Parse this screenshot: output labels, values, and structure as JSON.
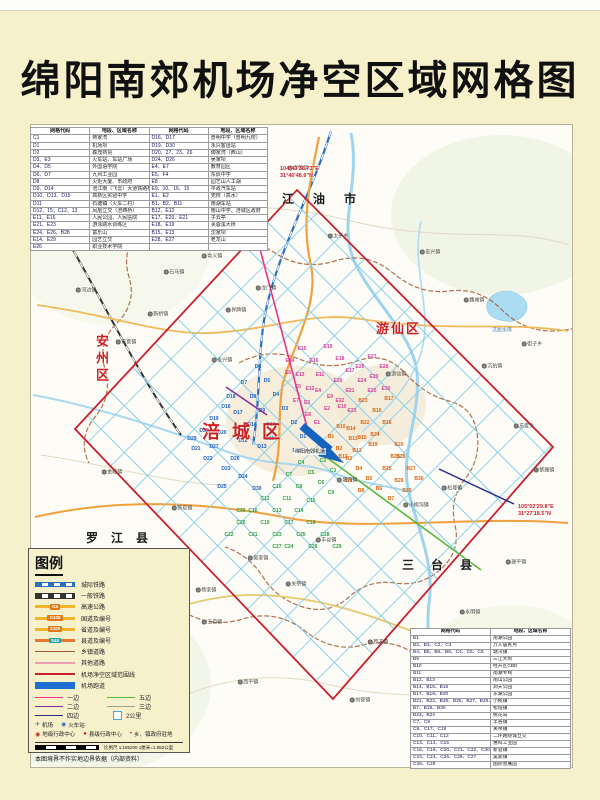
{
  "title": "绵阳南郊机场净空区域网格图",
  "colors": {
    "page_bg": "#f6f0cb",
    "boundary_red": "#c8202e",
    "grid_blue": "#86cfe8",
    "runway_blue": "#1565c0",
    "grid_codes": {
      "D": "#1d5fc4",
      "E": "#d93f9b",
      "C": "#2f9e44",
      "B": "#e0640f"
    }
  },
  "table_top_left": {
    "headers": [
      "网格代码",
      "地段、区域名称",
      "网格代码",
      "地段、区域名称"
    ],
    "rows": [
      [
        "C1",
        "蒋家湾",
        "D16、D17",
        "普明中学（普明九校）"
      ],
      [
        "D1",
        "机场坝",
        "D19、D30",
        "永兴客运站"
      ],
      [
        "D2",
        "森茂商贸",
        "D20、27、23、26",
        "御家湾（西山）"
      ],
      [
        "D3、E3",
        "火车站、车站广场",
        "D24、D26",
        "吴家坝"
      ],
      [
        "D4、D5",
        "外国语学院",
        "E4、E7",
        "教育园区"
      ],
      [
        "D6、D7",
        "九州工业园",
        "E5、F4",
        "东辰中学"
      ],
      [
        "D8",
        "火炬大厦、市政府",
        "E8",
        "园艺山人工湖"
      ],
      [
        "D9、D14",
        "涪江南（飞云）大道铁路桥",
        "E9、10、16、15",
        "平政汽车站"
      ],
      [
        "D10、D13、D15",
        "高新区实验中学",
        "E1、E2",
        "党校（高水）"
      ],
      [
        "D11",
        "石塘镇（火车二村）",
        "B1、B2、B11",
        "南湖车站"
      ],
      [
        "D12、15；C12、13",
        "凤凰立交（涪西桥）",
        "B12、E12",
        "南山中学、涪城区政府"
      ],
      [
        "E11、E16",
        "人民公园、人民医院",
        "E17、E20、E21",
        "子云亭"
      ],
      [
        "E21、E23",
        "游泳跳水训练区",
        "E18、E19",
        "芙蓉溪大桥"
      ],
      [
        "E24、E26、B28",
        "富乐山",
        "B15、E13",
        "沈家坝"
      ],
      [
        "E14、E29",
        "园艺立交",
        "E28、E27",
        "老龙山"
      ],
      [
        "E26",
        "职业技术学院",
        "",
        ""
      ]
    ]
  },
  "table_bottom_right": {
    "headers": [
      "网格代码",
      "地段、区域名称"
    ],
    "rows": [
      [
        "B1",
        "南湖公园"
      ],
      [
        "B2、B3、C2、C3",
        "万人居民点"
      ],
      [
        "B4、B5、B6、B8、C4、C5、C6",
        "塘汛镇"
      ],
      [
        "B9",
        "三江大坝"
      ],
      [
        "B10",
        "经开区CBD"
      ],
      [
        "B11",
        "南湖专线"
      ],
      [
        "B12、B13",
        "南山公园"
      ],
      [
        "B14、B15、B16",
        "洞天公园"
      ],
      [
        "B17、B18、B20",
        "东湖公园"
      ],
      [
        "B21、B22、B25、B26、B27、B28、B29",
        "小枧镇"
      ],
      [
        "B7、B19、B30",
        "松垭镇"
      ],
      [
        "B23、B24",
        "桃花岛"
      ],
      [
        "C7、C9",
        "丰谷镇"
      ],
      [
        "C8、C17、C18",
        "关帝镇"
      ],
      [
        "C10、C11、C12",
        "二环路绕城立交"
      ],
      [
        "C13、C14、C15",
        "惠科工业园"
      ],
      [
        "C16、C19、C20、C21、C22、C30",
        "新皂镇"
      ],
      [
        "C23、C24、C25、C26、C27",
        "吴家镇"
      ],
      [
        "C28、C29",
        "国际会展园"
      ]
    ]
  },
  "legend": {
    "title": "图例",
    "line_items": [
      {
        "label": "城际铁路",
        "type": "rail",
        "color": "#2a6fc0"
      },
      {
        "label": "一般铁路",
        "type": "rail",
        "color": "#333333"
      },
      {
        "label": "高速公路",
        "type": "road",
        "color": "#f3b32c",
        "badge": "G5",
        "badge_bg": "#e07818"
      },
      {
        "label": "国道及编号",
        "type": "road",
        "color": "#f3b32c",
        "badge": "G108",
        "badge_bg": "#e07818"
      },
      {
        "label": "省道及编号",
        "type": "road",
        "color": "#f3b32c",
        "badge": "S105",
        "badge_bg": "#e07818"
      },
      {
        "label": "县道及编号",
        "type": "road",
        "color": "#e87830",
        "badge": "S40",
        "badge_bg": "#27a39b"
      },
      {
        "label": "乡镇道路",
        "type": "line",
        "color": "#a85a30",
        "h": 1
      },
      {
        "label": "其他道路",
        "type": "line",
        "color": "#e8a0ae",
        "h": 2
      },
      {
        "label": "机场净空区域范围线",
        "type": "line",
        "color": "#cc1f2e",
        "h": 2
      },
      {
        "label": "机场跑道",
        "type": "line",
        "color": "#1f6fd0",
        "h": 7
      }
    ],
    "edges": [
      {
        "label": "一边",
        "color": "#e8358a"
      },
      {
        "label": "五边",
        "color": "#5cb83c"
      },
      {
        "label": "二边",
        "color": "#8a2d9c"
      },
      {
        "label": "三边",
        "color": "#9aa48e"
      },
      {
        "label": "四边",
        "color": "#2a2a8c"
      }
    ],
    "square_label": "2公里",
    "symbols_row1": [
      {
        "glyph": "✈",
        "color": "#2a6fc0",
        "label": "机场"
      },
      {
        "glyph": "◉",
        "color": "#2a6fc0",
        "label": "火车站"
      }
    ],
    "symbols_row2": [
      {
        "glyph": "◉",
        "color": "#cc2222",
        "label": "地级行政中心"
      },
      {
        "glyph": "●",
        "color": "#cc2222",
        "label": "县级行政中心"
      },
      {
        "glyph": "•",
        "color": "#cc2222",
        "label": "乡、镇政府驻地"
      }
    ],
    "scale_text": "比例尺 1:185200  1厘米=1.852公里",
    "disclaimer": "本图境界不作实地边界依据（内部资料）"
  },
  "map": {
    "airport_label": "绵阳南郊机场",
    "district_labels": [
      {
        "text": "江 油 市",
        "x": 282,
        "y": 190,
        "color": "#1a1a1a",
        "size": 12,
        "ls": 8,
        "vertical": false
      },
      {
        "text": "安州区",
        "x": 92,
        "y": 334,
        "color": "#cc2222",
        "size": 13,
        "ls": 4,
        "vertical": true
      },
      {
        "text": "游仙区",
        "x": 376,
        "y": 318,
        "color": "#cc2222",
        "size": 13,
        "ls": 2,
        "vertical": false
      },
      {
        "text": "涪城区",
        "x": 202,
        "y": 418,
        "color": "#cc2222",
        "size": 18,
        "ls": 12,
        "vertical": false
      },
      {
        "text": "罗 江 县",
        "x": 86,
        "y": 529,
        "color": "#1a1a1a",
        "size": 12,
        "ls": 5,
        "vertical": false
      },
      {
        "text": "三 台 县",
        "x": 402,
        "y": 556,
        "color": "#1a1a1a",
        "size": 12,
        "ls": 7,
        "vertical": false
      }
    ],
    "coord_labels": [
      {
        "line1": "104°43'36.73\"E",
        "line2": "31°40'48.6\"N",
        "x": 280,
        "y": 166
      },
      {
        "line1": "105°02'29.8\"E",
        "line2": "31°27'18.5\"N",
        "x": 518,
        "y": 504
      }
    ],
    "water_labels": [
      {
        "text": "沉抗水库",
        "x": 502,
        "y": 330
      }
    ],
    "grid_labels": [
      {
        "c": "D1",
        "x": 303,
        "y": 437
      },
      {
        "c": "D2",
        "x": 294,
        "y": 423
      },
      {
        "c": "D3",
        "x": 285,
        "y": 409
      },
      {
        "c": "D4",
        "x": 276,
        "y": 395
      },
      {
        "c": "D5",
        "x": 267,
        "y": 381
      },
      {
        "c": "D6",
        "x": 258,
        "y": 367
      },
      {
        "c": "D7",
        "x": 244,
        "y": 383
      },
      {
        "c": "D8",
        "x": 253,
        "y": 397
      },
      {
        "c": "D9",
        "x": 262,
        "y": 411
      },
      {
        "c": "D10",
        "x": 271,
        "y": 425
      },
      {
        "c": "D11",
        "x": 297,
        "y": 451
      },
      {
        "c": "D12",
        "x": 243,
        "y": 441
      },
      {
        "c": "D13",
        "x": 262,
        "y": 447
      },
      {
        "c": "D14",
        "x": 252,
        "y": 425
      },
      {
        "c": "D15",
        "x": 270,
        "y": 439
      },
      {
        "c": "D16",
        "x": 226,
        "y": 407
      },
      {
        "c": "D17",
        "x": 238,
        "y": 413
      },
      {
        "c": "D18",
        "x": 231,
        "y": 397
      },
      {
        "c": "D19",
        "x": 214,
        "y": 419
      },
      {
        "c": "D20",
        "x": 222,
        "y": 433
      },
      {
        "c": "D21",
        "x": 196,
        "y": 449
      },
      {
        "c": "D22",
        "x": 208,
        "y": 459
      },
      {
        "c": "D23",
        "x": 226,
        "y": 469
      },
      {
        "c": "D24",
        "x": 243,
        "y": 477
      },
      {
        "c": "D25",
        "x": 222,
        "y": 487
      },
      {
        "c": "D26",
        "x": 235,
        "y": 459
      },
      {
        "c": "D27",
        "x": 214,
        "y": 447
      },
      {
        "c": "D28",
        "x": 204,
        "y": 431
      },
      {
        "c": "D29",
        "x": 192,
        "y": 439
      },
      {
        "c": "D30",
        "x": 257,
        "y": 489
      },
      {
        "c": "E1",
        "x": 317,
        "y": 423
      },
      {
        "c": "E2",
        "x": 327,
        "y": 409
      },
      {
        "c": "E3",
        "x": 307,
        "y": 403
      },
      {
        "c": "E4",
        "x": 318,
        "y": 391
      },
      {
        "c": "E5",
        "x": 298,
        "y": 387
      },
      {
        "c": "E6",
        "x": 288,
        "y": 373
      },
      {
        "c": "E7",
        "x": 296,
        "y": 401
      },
      {
        "c": "E8",
        "x": 308,
        "y": 415
      },
      {
        "c": "E9",
        "x": 330,
        "y": 397
      },
      {
        "c": "E10",
        "x": 342,
        "y": 407
      },
      {
        "c": "E11",
        "x": 320,
        "y": 375
      },
      {
        "c": "E12",
        "x": 310,
        "y": 389
      },
      {
        "c": "E13",
        "x": 300,
        "y": 375
      },
      {
        "c": "E14",
        "x": 290,
        "y": 361
      },
      {
        "c": "E15",
        "x": 302,
        "y": 349
      },
      {
        "c": "E16",
        "x": 314,
        "y": 361
      },
      {
        "c": "E17",
        "x": 350,
        "y": 371
      },
      {
        "c": "E18",
        "x": 340,
        "y": 359
      },
      {
        "c": "E19",
        "x": 328,
        "y": 347
      },
      {
        "c": "E20",
        "x": 338,
        "y": 381
      },
      {
        "c": "E21",
        "x": 350,
        "y": 391
      },
      {
        "c": "E22",
        "x": 340,
        "y": 401
      },
      {
        "c": "E23",
        "x": 352,
        "y": 411
      },
      {
        "c": "E24",
        "x": 362,
        "y": 381
      },
      {
        "c": "E25",
        "x": 372,
        "y": 391
      },
      {
        "c": "E26",
        "x": 360,
        "y": 367
      },
      {
        "c": "E27",
        "x": 372,
        "y": 357
      },
      {
        "c": "E28",
        "x": 384,
        "y": 367
      },
      {
        "c": "E29",
        "x": 374,
        "y": 377
      },
      {
        "c": "E30",
        "x": 386,
        "y": 389
      },
      {
        "c": "B1",
        "x": 331,
        "y": 437
      },
      {
        "c": "B2",
        "x": 339,
        "y": 449
      },
      {
        "c": "B3",
        "x": 349,
        "y": 459
      },
      {
        "c": "B4",
        "x": 359,
        "y": 469
      },
      {
        "c": "B5",
        "x": 369,
        "y": 479
      },
      {
        "c": "B6",
        "x": 379,
        "y": 489
      },
      {
        "c": "B7",
        "x": 391,
        "y": 499
      },
      {
        "c": "B8",
        "x": 361,
        "y": 491
      },
      {
        "c": "B9",
        "x": 349,
        "y": 481
      },
      {
        "c": "B10",
        "x": 341,
        "y": 427
      },
      {
        "c": "B11",
        "x": 353,
        "y": 439
      },
      {
        "c": "B12",
        "x": 343,
        "y": 457
      },
      {
        "c": "B13",
        "x": 357,
        "y": 451
      },
      {
        "c": "B14",
        "x": 351,
        "y": 429
      },
      {
        "c": "B15",
        "x": 362,
        "y": 438
      },
      {
        "c": "B16",
        "x": 377,
        "y": 411
      },
      {
        "c": "B17",
        "x": 389,
        "y": 399
      },
      {
        "c": "B18",
        "x": 387,
        "y": 423
      },
      {
        "c": "B19",
        "x": 373,
        "y": 445
      },
      {
        "c": "B20",
        "x": 399,
        "y": 445
      },
      {
        "c": "B21",
        "x": 395,
        "y": 457
      },
      {
        "c": "B22",
        "x": 365,
        "y": 423
      },
      {
        "c": "B23",
        "x": 363,
        "y": 401
      },
      {
        "c": "B24",
        "x": 375,
        "y": 435
      },
      {
        "c": "B25",
        "x": 387,
        "y": 469
      },
      {
        "c": "B26",
        "x": 399,
        "y": 481
      },
      {
        "c": "B27",
        "x": 411,
        "y": 469
      },
      {
        "c": "B28",
        "x": 401,
        "y": 457
      },
      {
        "c": "B29",
        "x": 407,
        "y": 491
      },
      {
        "c": "B30",
        "x": 419,
        "y": 479
      },
      {
        "c": "C1",
        "x": 313,
        "y": 451
      },
      {
        "c": "C2",
        "x": 323,
        "y": 461
      },
      {
        "c": "C3",
        "x": 333,
        "y": 471
      },
      {
        "c": "C4",
        "x": 301,
        "y": 463
      },
      {
        "c": "C5",
        "x": 311,
        "y": 473
      },
      {
        "c": "C6",
        "x": 321,
        "y": 483
      },
      {
        "c": "C7",
        "x": 289,
        "y": 475
      },
      {
        "c": "C8",
        "x": 299,
        "y": 487
      },
      {
        "c": "C9",
        "x": 331,
        "y": 493
      },
      {
        "c": "C10",
        "x": 277,
        "y": 487
      },
      {
        "c": "C11",
        "x": 287,
        "y": 499
      },
      {
        "c": "C12",
        "x": 265,
        "y": 499
      },
      {
        "c": "C13",
        "x": 277,
        "y": 511
      },
      {
        "c": "C14",
        "x": 299,
        "y": 511
      },
      {
        "c": "C15",
        "x": 311,
        "y": 501
      },
      {
        "c": "C16",
        "x": 253,
        "y": 511
      },
      {
        "c": "C17",
        "x": 289,
        "y": 523
      },
      {
        "c": "C18",
        "x": 311,
        "y": 523
      },
      {
        "c": "C19",
        "x": 265,
        "y": 523
      },
      {
        "c": "C20",
        "x": 241,
        "y": 523
      },
      {
        "c": "C21",
        "x": 253,
        "y": 535
      },
      {
        "c": "C22",
        "x": 229,
        "y": 535
      },
      {
        "c": "C23",
        "x": 277,
        "y": 535
      },
      {
        "c": "C24",
        "x": 289,
        "y": 547
      },
      {
        "c": "C25",
        "x": 301,
        "y": 535
      },
      {
        "c": "C26",
        "x": 313,
        "y": 547
      },
      {
        "c": "C27",
        "x": 277,
        "y": 547
      },
      {
        "c": "C28",
        "x": 325,
        "y": 535
      },
      {
        "c": "C29",
        "x": 337,
        "y": 547
      },
      {
        "c": "C30",
        "x": 241,
        "y": 511
      }
    ],
    "towns": [
      {
        "n": "青义镇",
        "x": 212,
        "y": 256
      },
      {
        "n": "石马镇",
        "x": 174,
        "y": 272
      },
      {
        "n": "龙门镇",
        "x": 266,
        "y": 288
      },
      {
        "n": "新桥镇",
        "x": 158,
        "y": 314
      },
      {
        "n": "花荄镇",
        "x": 126,
        "y": 342
      },
      {
        "n": "界牌镇",
        "x": 236,
        "y": 310
      },
      {
        "n": "永兴镇",
        "x": 222,
        "y": 360
      },
      {
        "n": "河边镇",
        "x": 86,
        "y": 290
      },
      {
        "n": "柏林镇",
        "x": 148,
        "y": 238
      },
      {
        "n": "青莲镇",
        "x": 298,
        "y": 168
      },
      {
        "n": "九岭镇",
        "x": 144,
        "y": 198
      },
      {
        "n": "忠兴镇",
        "x": 430,
        "y": 252
      },
      {
        "n": "太平乡",
        "x": 338,
        "y": 236
      },
      {
        "n": "魏城镇",
        "x": 474,
        "y": 300
      },
      {
        "n": "沉抗镇",
        "x": 492,
        "y": 366
      },
      {
        "n": "街子乡",
        "x": 532,
        "y": 344
      },
      {
        "n": "游仙镇",
        "x": 396,
        "y": 374
      },
      {
        "n": "东宣乡",
        "x": 524,
        "y": 426
      },
      {
        "n": "黎雅镇",
        "x": 544,
        "y": 470
      },
      {
        "n": "塘汛镇",
        "x": 347,
        "y": 480
      },
      {
        "n": "丰谷镇",
        "x": 326,
        "y": 540
      },
      {
        "n": "松垭镇",
        "x": 452,
        "y": 488
      },
      {
        "n": "小枧沟镇",
        "x": 416,
        "y": 505
      },
      {
        "n": "吴家镇",
        "x": 258,
        "y": 558
      },
      {
        "n": "新皂镇",
        "x": 182,
        "y": 508
      },
      {
        "n": "关帝镇",
        "x": 296,
        "y": 584
      },
      {
        "n": "杨家镇",
        "x": 206,
        "y": 590
      },
      {
        "n": "玉皇镇",
        "x": 212,
        "y": 622
      },
      {
        "n": "金峰镇",
        "x": 112,
        "y": 472
      },
      {
        "n": "芦溪镇",
        "x": 378,
        "y": 642
      },
      {
        "n": "永明镇",
        "x": 470,
        "y": 612
      },
      {
        "n": "建平镇",
        "x": 516,
        "y": 562
      },
      {
        "n": "西平镇",
        "x": 248,
        "y": 682
      },
      {
        "n": "刘营镇",
        "x": 360,
        "y": 700
      }
    ]
  }
}
